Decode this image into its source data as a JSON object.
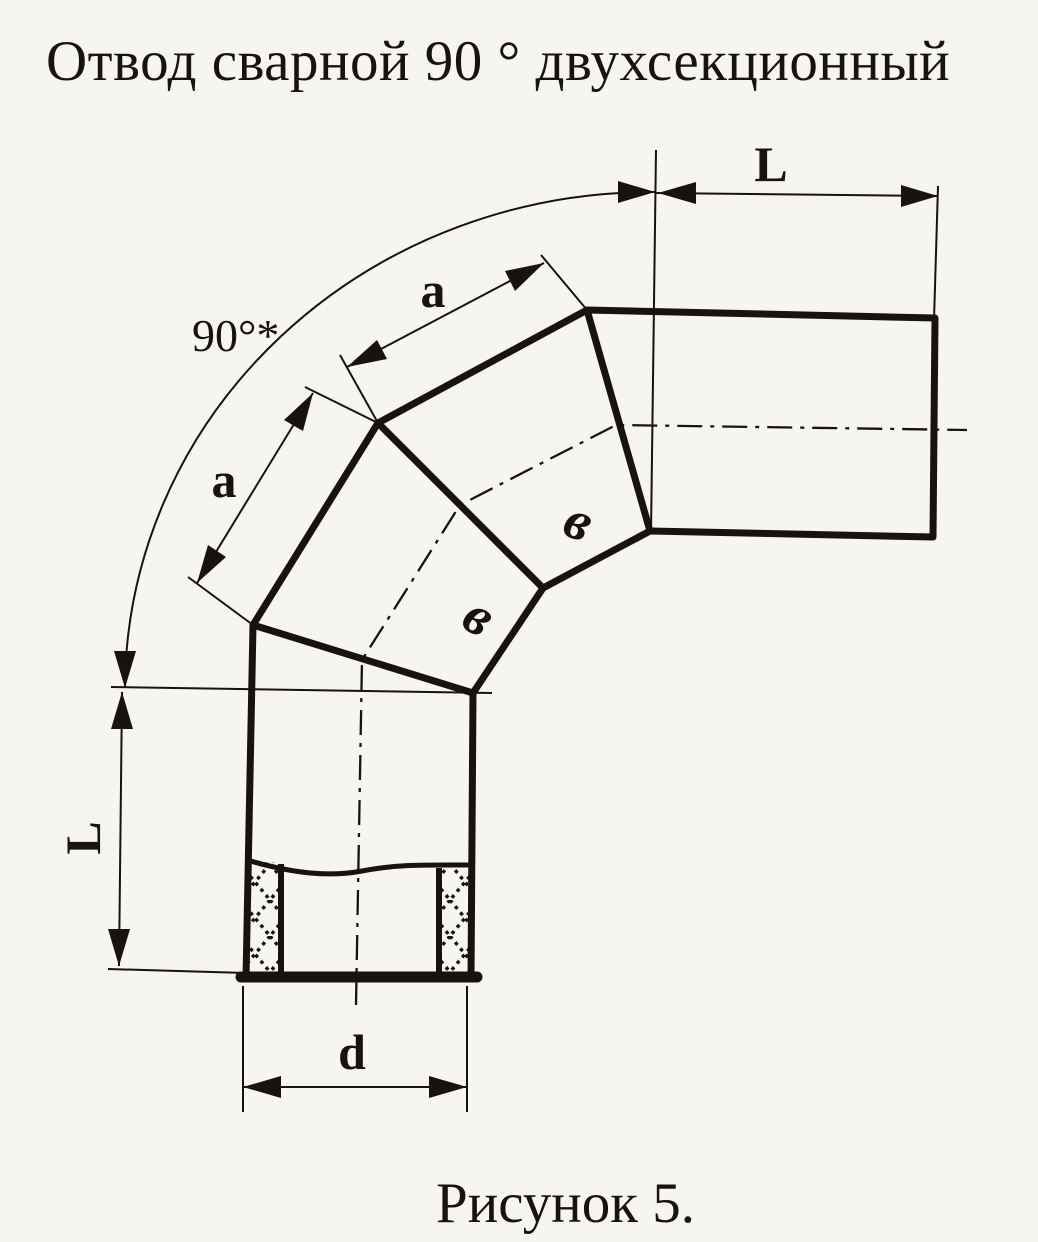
{
  "title": "Отвод сварной 90 ° двухсекционный",
  "caption": "Рисунок 5.",
  "colors": {
    "paper": "#f7f5f0",
    "ink": "#17130e"
  },
  "drawing": {
    "type": "engineering-diagram",
    "subject": "welded 90-degree two-section pipe elbow, dimensioned sketch",
    "labels": {
      "angle": "90°*",
      "length_top": "L",
      "length_side": "L",
      "segment_a_upper": "a",
      "segment_a_lower": "a",
      "diameter": "d",
      "weld_mark_upper": "в",
      "weld_mark_lower": "в"
    }
  }
}
